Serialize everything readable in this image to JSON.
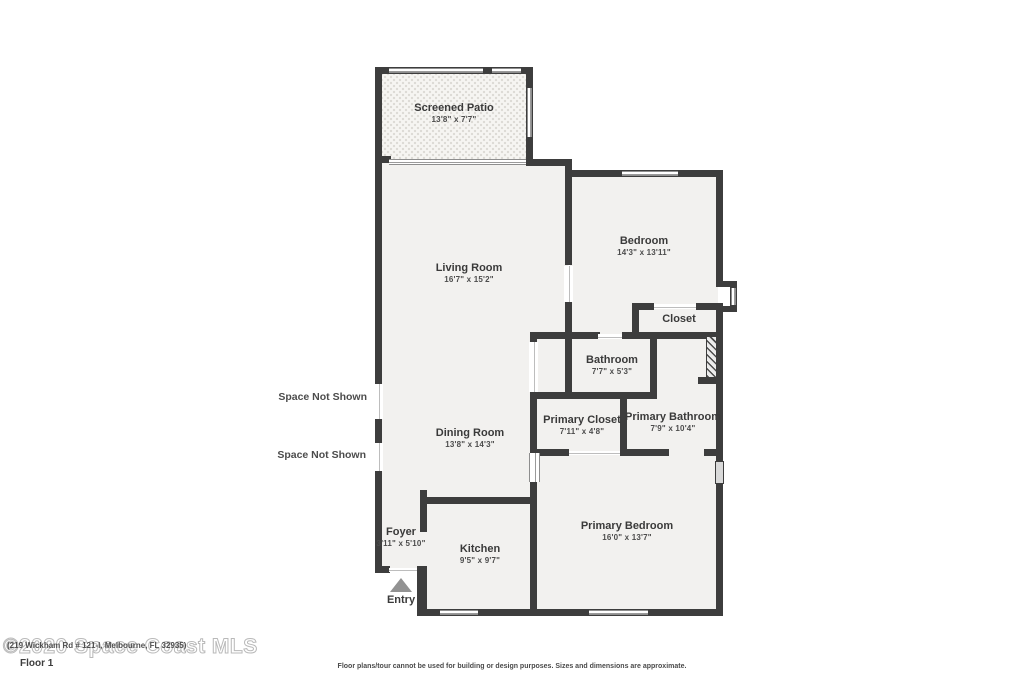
{
  "colors": {
    "wall": "#3d3d3d",
    "floor": "#f2f1ef",
    "patio_dot": "#dcdad5",
    "window_line": "#8e8e8e",
    "label": "#3a3a3a",
    "entry_arrow": "#929292",
    "watermark": "#b9b9b9"
  },
  "rooms": [
    {
      "id": "screened_patio",
      "name": "Screened Patio",
      "dims": "13'8\" x 7'7\""
    },
    {
      "id": "living_room",
      "name": "Living Room",
      "dims": "16'7\" x 15'2\""
    },
    {
      "id": "bedroom",
      "name": "Bedroom",
      "dims": "14'3\" x 13'11\""
    },
    {
      "id": "closet",
      "name": "Closet",
      "dims": ""
    },
    {
      "id": "bathroom",
      "name": "Bathroom",
      "dims": "7'7\" x 5'3\""
    },
    {
      "id": "primary_closet",
      "name": "Primary Closet",
      "dims": "7'11\" x 4'8\""
    },
    {
      "id": "primary_bathroom",
      "name": "Primary Bathroom",
      "dims": "7'9\" x 10'4\""
    },
    {
      "id": "dining_room",
      "name": "Dining Room",
      "dims": "13'8\" x 14'3\""
    },
    {
      "id": "foyer",
      "name": "Foyer",
      "dims": "3'11\" x 5'10\""
    },
    {
      "id": "kitchen",
      "name": "Kitchen",
      "dims": "9'5\" x 9'7\""
    },
    {
      "id": "primary_bedroom",
      "name": "Primary Bedroom",
      "dims": "16'0\" x 13'7\""
    }
  ],
  "annotations": {
    "space_not_shown_1": "Space Not Shown",
    "space_not_shown_2": "Space Not Shown",
    "entry": "Entry",
    "floor_label": "Floor 1"
  },
  "watermark": {
    "large": "©2020 Space Coast MLS",
    "address": "(219 Wickham Rd # 121-I, Melbourne, FL 32935)"
  },
  "footer": {
    "disclaimer": "Floor plans/tour cannot be used for building or design purposes. Sizes and dimensions are approximate."
  }
}
